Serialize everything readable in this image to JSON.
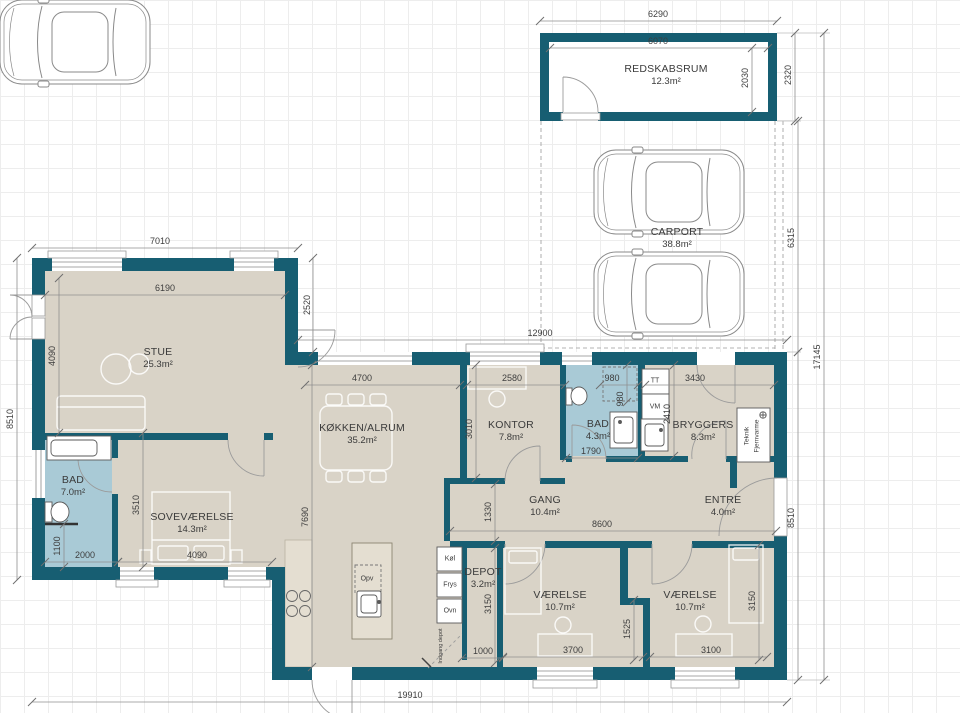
{
  "plan": {
    "type": "floor-plan",
    "language": "da",
    "colors": {
      "wall": "#175e72",
      "floor": "#d9d3c7",
      "bathroom": "#a9cad6",
      "counter": "#e4ded1",
      "grid": "#ededed",
      "dimension": "#3e3e3e"
    }
  },
  "rooms": [
    {
      "id": "redskabsrum",
      "name": "REDSKABSRUM",
      "area": "12.3m²",
      "x": 666,
      "y": 75
    },
    {
      "id": "carport",
      "name": "CARPORT",
      "area": "38.8m²",
      "x": 677,
      "y": 238
    },
    {
      "id": "stue",
      "name": "STUE",
      "area": "25.3m²",
      "x": 158,
      "y": 358
    },
    {
      "id": "koekken-alrum",
      "name": "KØKKEN/ALRUM",
      "area": "35.2m²",
      "x": 362,
      "y": 434
    },
    {
      "id": "kontor",
      "name": "KONTOR",
      "area": "7.8m²",
      "x": 511,
      "y": 431
    },
    {
      "id": "bad-1",
      "name": "BAD",
      "area": "4.3m²",
      "x": 598,
      "y": 430
    },
    {
      "id": "bryggers",
      "name": "BRYGGERS",
      "area": "8.3m²",
      "x": 703,
      "y": 431
    },
    {
      "id": "bad-2",
      "name": "BAD",
      "area": "7.0m²",
      "x": 73,
      "y": 486
    },
    {
      "id": "sovevaerelse",
      "name": "SOVEVÆRELSE",
      "area": "14.3m²",
      "x": 192,
      "y": 523
    },
    {
      "id": "gang",
      "name": "GANG",
      "area": "10.4m²",
      "x": 545,
      "y": 506
    },
    {
      "id": "entre",
      "name": "ENTRE",
      "area": "4.0m²",
      "x": 723,
      "y": 506
    },
    {
      "id": "depot",
      "name": "DEPOT",
      "area": "3.2m²",
      "x": 483,
      "y": 578
    },
    {
      "id": "vaerelse-1",
      "name": "VÆRELSE",
      "area": "10.7m²",
      "x": 560,
      "y": 601
    },
    {
      "id": "vaerelse-2",
      "name": "VÆRELSE",
      "area": "10.7m²",
      "x": 690,
      "y": 601
    }
  ],
  "dimensions": [
    {
      "v": "6290",
      "x": 658,
      "y": 14,
      "rot": 0,
      "l": [
        540,
        21,
        777,
        21
      ]
    },
    {
      "v": "6070",
      "x": 658,
      "y": 41,
      "rot": 0,
      "l": [
        550,
        48,
        768,
        48
      ]
    },
    {
      "v": "2030",
      "x": 745,
      "y": 78,
      "rot": 90,
      "l": [
        752,
        48,
        752,
        112
      ]
    },
    {
      "v": "2320",
      "x": 788,
      "y": 75,
      "rot": 90,
      "l": [
        795,
        33,
        795,
        121
      ]
    },
    {
      "v": "6315",
      "x": 791,
      "y": 238,
      "rot": 90,
      "l": [
        798,
        121,
        798,
        352
      ]
    },
    {
      "v": "17145",
      "x": 817,
      "y": 357,
      "rot": 90,
      "l": [
        824,
        33,
        824,
        680
      ]
    },
    {
      "v": "12900",
      "x": 540,
      "y": 333,
      "rot": 0,
      "l": [
        298,
        340,
        787,
        340
      ]
    },
    {
      "v": "7010",
      "x": 160,
      "y": 241,
      "rot": 0,
      "l": [
        32,
        248,
        298,
        248
      ]
    },
    {
      "v": "6190",
      "x": 165,
      "y": 288,
      "rot": 0,
      "l": [
        45,
        295,
        285,
        295
      ]
    },
    {
      "v": "2520",
      "x": 307,
      "y": 305,
      "rot": 90,
      "l": [
        313,
        258,
        313,
        352
      ]
    },
    {
      "v": "8510",
      "x": 10,
      "y": 419,
      "rot": 90,
      "l": [
        17,
        258,
        17,
        580
      ]
    },
    {
      "v": "4090",
      "x": 52,
      "y": 356,
      "rot": 90,
      "l": [
        59,
        278,
        59,
        433
      ]
    },
    {
      "v": "3510",
      "x": 136,
      "y": 505,
      "rot": 90,
      "l": [
        143,
        433,
        143,
        567
      ]
    },
    {
      "v": "2000",
      "x": 85,
      "y": 555,
      "rot": 0,
      "l": [
        45,
        562,
        118,
        562
      ]
    },
    {
      "v": "1100",
      "x": 57,
      "y": 546,
      "rot": 90,
      "l": [
        64,
        524,
        64,
        567
      ]
    },
    {
      "v": "4090",
      "x": 197,
      "y": 555,
      "rot": 0,
      "l": [
        118,
        562,
        272,
        562
      ]
    },
    {
      "v": "7690",
      "x": 305,
      "y": 517,
      "rot": 90,
      "l": [
        312,
        365,
        312,
        667
      ]
    },
    {
      "v": "4700",
      "x": 362,
      "y": 378,
      "rot": 0,
      "l": [
        305,
        385,
        460,
        385
      ]
    },
    {
      "v": "2580",
      "x": 512,
      "y": 378,
      "rot": 0,
      "l": [
        467,
        385,
        565,
        385
      ]
    },
    {
      "v": "3010",
      "x": 469,
      "y": 429,
      "rot": 90,
      "l": [
        476,
        365,
        476,
        478
      ]
    },
    {
      "v": "1330",
      "x": 488,
      "y": 512,
      "rot": 90,
      "l": [
        495,
        484,
        495,
        541
      ]
    },
    {
      "v": "980",
      "x": 612,
      "y": 378,
      "rot": 0,
      "l": [
        600,
        385,
        638,
        385
      ]
    },
    {
      "v": "980",
      "x": 620,
      "y": 399,
      "rot": 90,
      "l": [
        627,
        365,
        627,
        402
      ]
    },
    {
      "v": "1790",
      "x": 591,
      "y": 451,
      "rot": 0,
      "l": [
        566,
        458,
        638,
        458
      ]
    },
    {
      "v": "3430",
      "x": 695,
      "y": 378,
      "rot": 0,
      "l": [
        645,
        385,
        774,
        385
      ]
    },
    {
      "v": "2410",
      "x": 667,
      "y": 414,
      "rot": 90,
      "l": [
        674,
        365,
        674,
        456
      ]
    },
    {
      "v": "8600",
      "x": 602,
      "y": 524,
      "rot": 0,
      "l": [
        450,
        531,
        776,
        531
      ]
    },
    {
      "v": "8510",
      "x": 791,
      "y": 518,
      "rot": 90,
      "l": [
        798,
        352,
        798,
        680
      ]
    },
    {
      "v": "3150",
      "x": 488,
      "y": 604,
      "rot": 90,
      "l": [
        495,
        548,
        495,
        663
      ]
    },
    {
      "v": "1525",
      "x": 627,
      "y": 629,
      "rot": 90,
      "l": [
        634,
        600,
        634,
        660
      ]
    },
    {
      "v": "3150",
      "x": 752,
      "y": 601,
      "rot": 90,
      "l": [
        759,
        545,
        759,
        660
      ]
    },
    {
      "v": "1000",
      "x": 483,
      "y": 651,
      "rot": 0,
      "l": [
        462,
        658,
        503,
        658
      ]
    },
    {
      "v": "3700",
      "x": 573,
      "y": 650,
      "rot": 0,
      "l": [
        503,
        657,
        643,
        657
      ]
    },
    {
      "v": "3100",
      "x": 711,
      "y": 650,
      "rot": 0,
      "l": [
        650,
        657,
        767,
        657
      ]
    },
    {
      "v": "19910",
      "x": 410,
      "y": 695,
      "rot": 0,
      "l": [
        32,
        702,
        787,
        702
      ]
    }
  ],
  "annotations": [
    {
      "t": "TT",
      "x": 655,
      "y": 381,
      "rot": 0,
      "s": 7
    },
    {
      "t": "VM",
      "x": 655,
      "y": 407,
      "rot": 0,
      "s": 7
    },
    {
      "t": "Opv",
      "x": 367,
      "y": 579,
      "rot": 0,
      "s": 7
    },
    {
      "t": "Køl",
      "x": 450,
      "y": 559,
      "rot": 0,
      "s": 7
    },
    {
      "t": "Frys",
      "x": 450,
      "y": 585,
      "rot": 0,
      "s": 7
    },
    {
      "t": "Ovn",
      "x": 450,
      "y": 611,
      "rot": 0,
      "s": 7
    },
    {
      "t": "Teknik",
      "x": 747,
      "y": 436,
      "rot": 90,
      "s": 6.5
    },
    {
      "t": "Fjernvarme",
      "x": 757,
      "y": 436,
      "rot": 90,
      "s": 6.5
    },
    {
      "t": "Indgang depot",
      "x": 441,
      "y": 646,
      "rot": 90,
      "s": 5.5
    }
  ]
}
